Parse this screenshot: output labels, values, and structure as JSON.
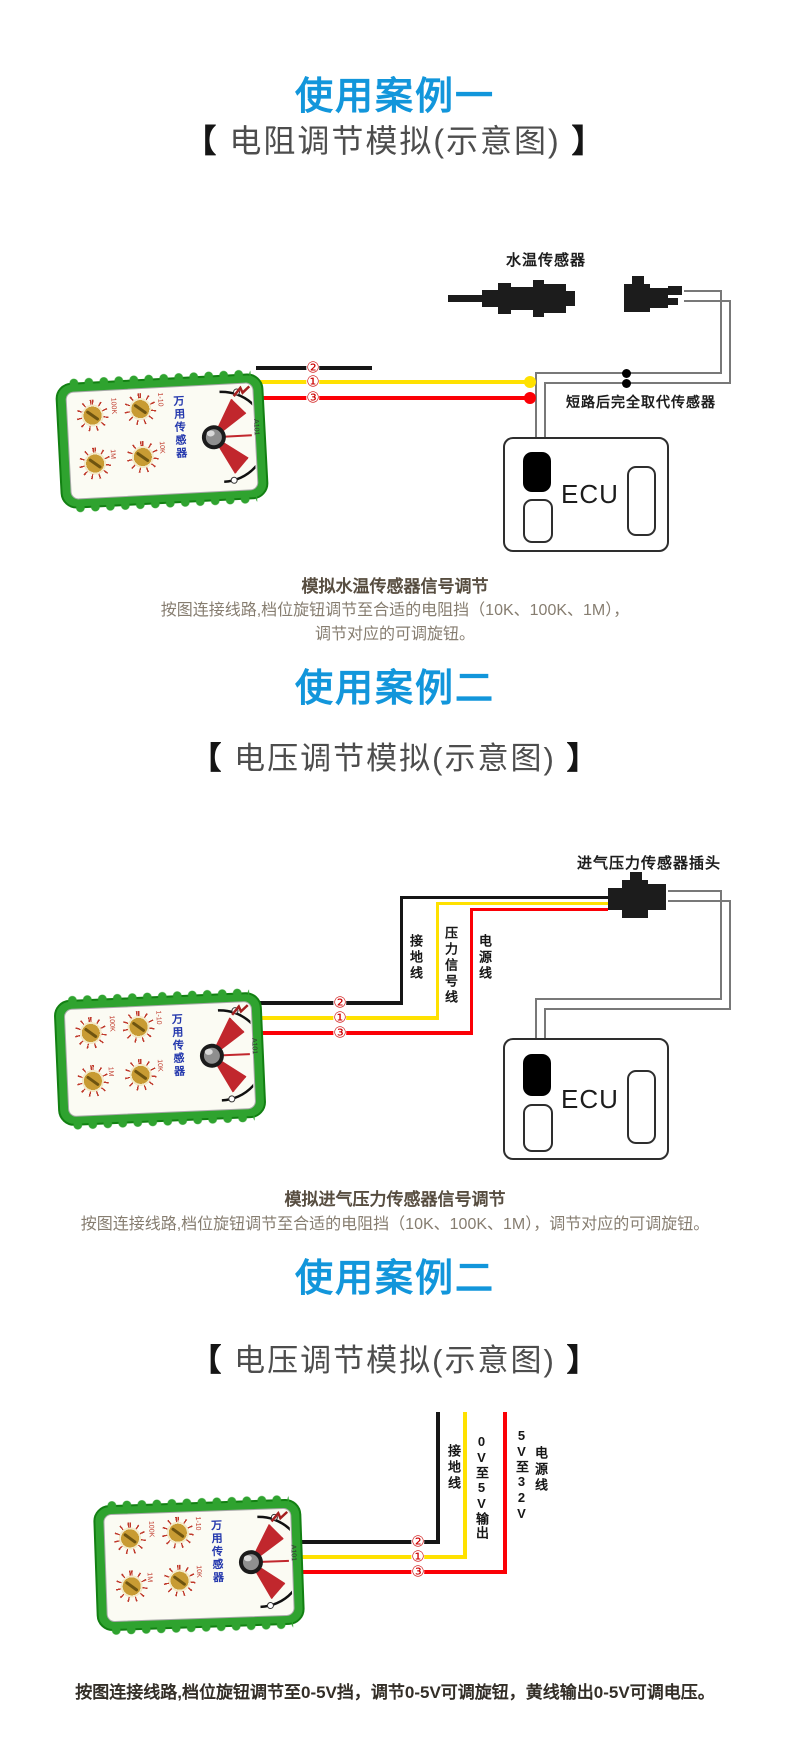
{
  "brand_accent": "#1296db",
  "brackets": {
    "open": "【",
    "close": "】"
  },
  "case1": {
    "title": "使用案例一",
    "subtitle": "电阻调节模拟(示意图)",
    "diagram": {
      "sensor_label": "水温传感器",
      "short_note": "短路后完全取代传感器",
      "ecu": "ECU",
      "nums": [
        "②",
        "①",
        "③"
      ]
    },
    "caption_title": "模拟水温传感器信号调节",
    "caption_line1": "按图连接线路,档位旋钮调节至合适的电阻挡（10K、100K、1M），",
    "caption_line2": "调节对应的可调旋钮。"
  },
  "case2": {
    "title": "使用案例二",
    "subtitle": "电压调节模拟(示意图)",
    "diagram": {
      "plug_label": "进气压力传感器插头",
      "wire1": "接地线",
      "wire2": "压力信号线",
      "wire3": "电源线",
      "ecu": "ECU",
      "nums": [
        "②",
        "①",
        "③"
      ]
    },
    "caption_title": "模拟进气压力传感器信号调节",
    "caption_line1": "按图连接线路,档位旋钮调节至合适的电阻挡（10K、100K、1M），调节对应的可调旋钮。"
  },
  "case3": {
    "title": "使用案例二",
    "subtitle": "电压调节模拟(示意图)",
    "diagram": {
      "wire1": "接地线",
      "wire2": "0V至5V输出",
      "wire3a": "5V至32V",
      "wire3b": "电源线",
      "nums": [
        "②",
        "①",
        "③"
      ]
    },
    "caption_line1": "按图连接线路,档位旋钮调节至0-5V挡，调节0-5V可调旋钮，黄线输出0-5V可调电压。"
  },
  "device": {
    "name_vertical": "万用传感器",
    "model": "A101",
    "knob1": "100K",
    "knob2": "1-10",
    "knob3": "1M",
    "knob4": "10K"
  }
}
